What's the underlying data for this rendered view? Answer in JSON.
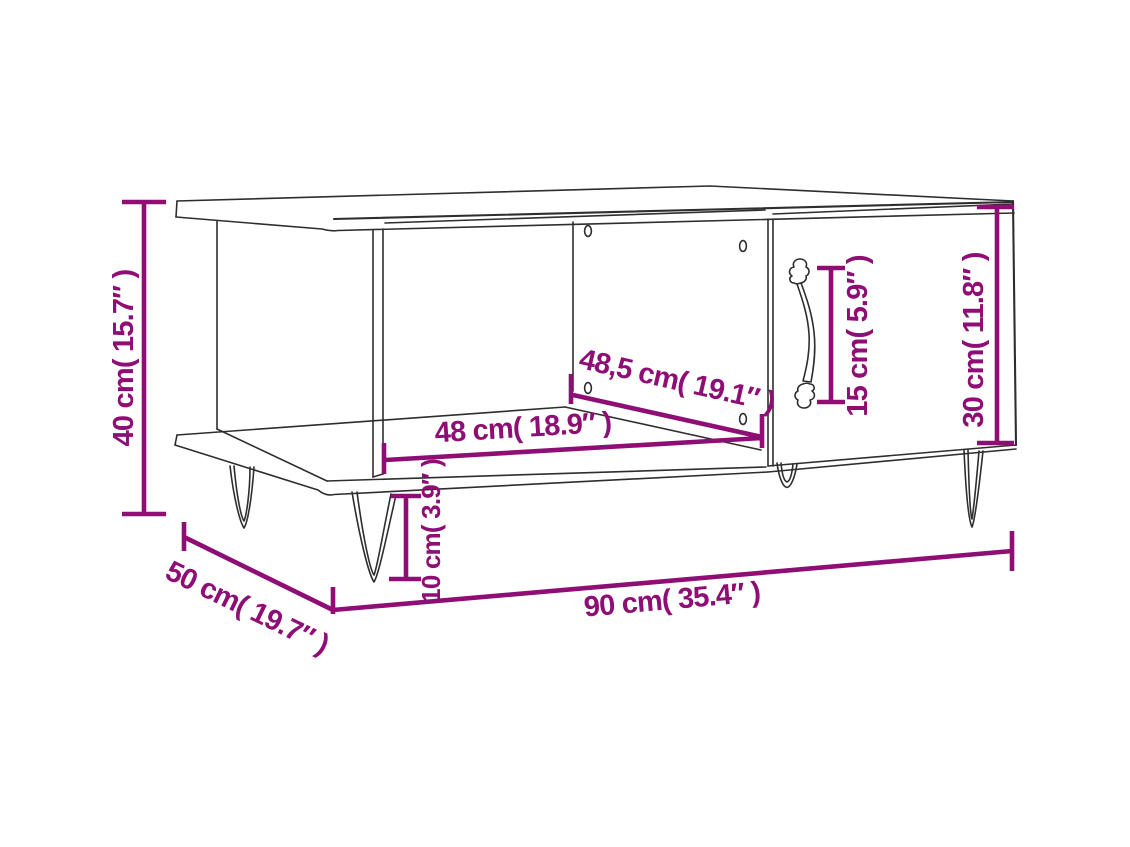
{
  "page": {
    "background": "#ffffff"
  },
  "diagram": {
    "title": "Coffee table dimension diagram",
    "subject": "coffee table with open compartment, door with ornate handle and hairpin legs",
    "accent_color": "#8e0e75",
    "outline_color": "#2e2e2e",
    "dimensions": [
      {
        "id": "height",
        "label": "40 cm( 15.7″ )",
        "value_cm": "40",
        "value_inches": "15.7",
        "placement": "left-vertical"
      },
      {
        "id": "depth",
        "label": "50 cm( 19.7″ )",
        "value_cm": "50",
        "value_inches": "19.7",
        "placement": "bottom-left-diagonal"
      },
      {
        "id": "width",
        "label": "90 cm( 35.4″ )",
        "value_cm": "90",
        "value_inches": "35.4",
        "placement": "bottom-front"
      },
      {
        "id": "shelf-width",
        "label": "48 cm( 18.9″ )",
        "value_cm": "48",
        "value_inches": "18.9",
        "placement": "inner-shelf-front"
      },
      {
        "id": "shelf-diagonal",
        "label": "48,5 cm( 19.1″ )",
        "value_cm": "48,5",
        "value_inches": "19.1",
        "placement": "inner-shelf-diagonal"
      },
      {
        "id": "leg-height",
        "label": "10 cm( 3.9″ )",
        "value_cm": "10",
        "value_inches": "3.9",
        "placement": "front-leg-vertical"
      },
      {
        "id": "handle-height",
        "label": "15 cm( 5.9″ )",
        "value_cm": "15",
        "value_inches": "5.9",
        "placement": "door-handle-vertical"
      },
      {
        "id": "door-height",
        "label": "30 cm( 11.8″ )",
        "value_cm": "30",
        "value_inches": "11.8",
        "placement": "door-right-vertical"
      }
    ]
  }
}
